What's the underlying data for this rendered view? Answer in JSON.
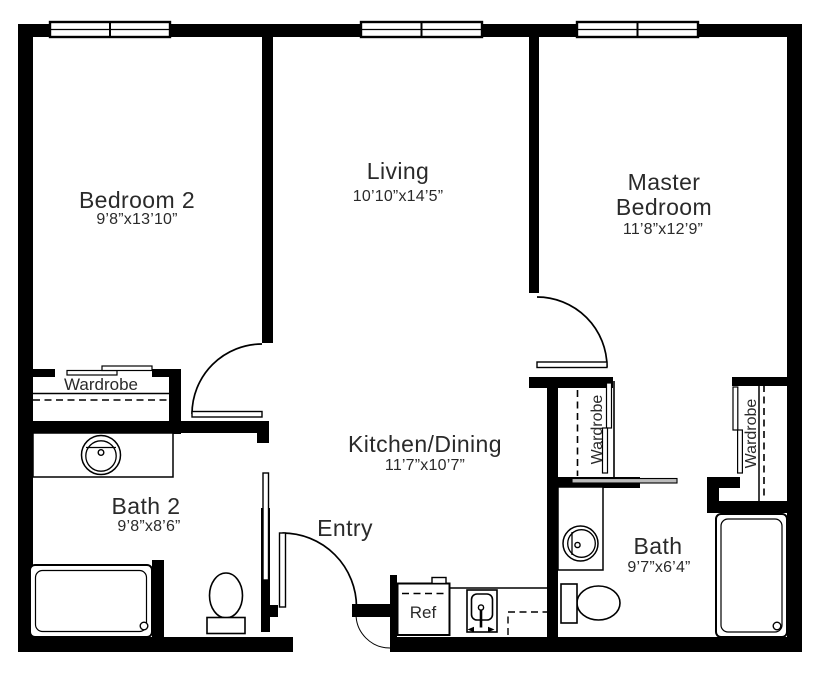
{
  "rooms": {
    "bedroom2": {
      "name": "Bedroom 2",
      "dims": "9’8”x13’10”"
    },
    "living": {
      "name": "Living",
      "dims": "10’10”x14’5”"
    },
    "master": {
      "name_line1": "Master",
      "name_line2": "Bedroom",
      "dims": "11’8”x12’9”"
    },
    "kitchen": {
      "name": "Kitchen/Dining",
      "dims": "11’7”x10’7”"
    },
    "bath2": {
      "name": "Bath 2",
      "dims": "9’8”x8’6”"
    },
    "bath": {
      "name": "Bath",
      "dims": "9’7”x6’4”"
    },
    "entry": {
      "name": "Entry"
    }
  },
  "fixtures": {
    "wardrobe_bedroom2": "Wardrobe",
    "wardrobe_hall": "Wardrobe",
    "wardrobe_master": "Wardrobe",
    "refrigerator": "Ref"
  },
  "colors": {
    "wall": "#000000",
    "text": "#2a2a2a",
    "background": "#ffffff"
  }
}
